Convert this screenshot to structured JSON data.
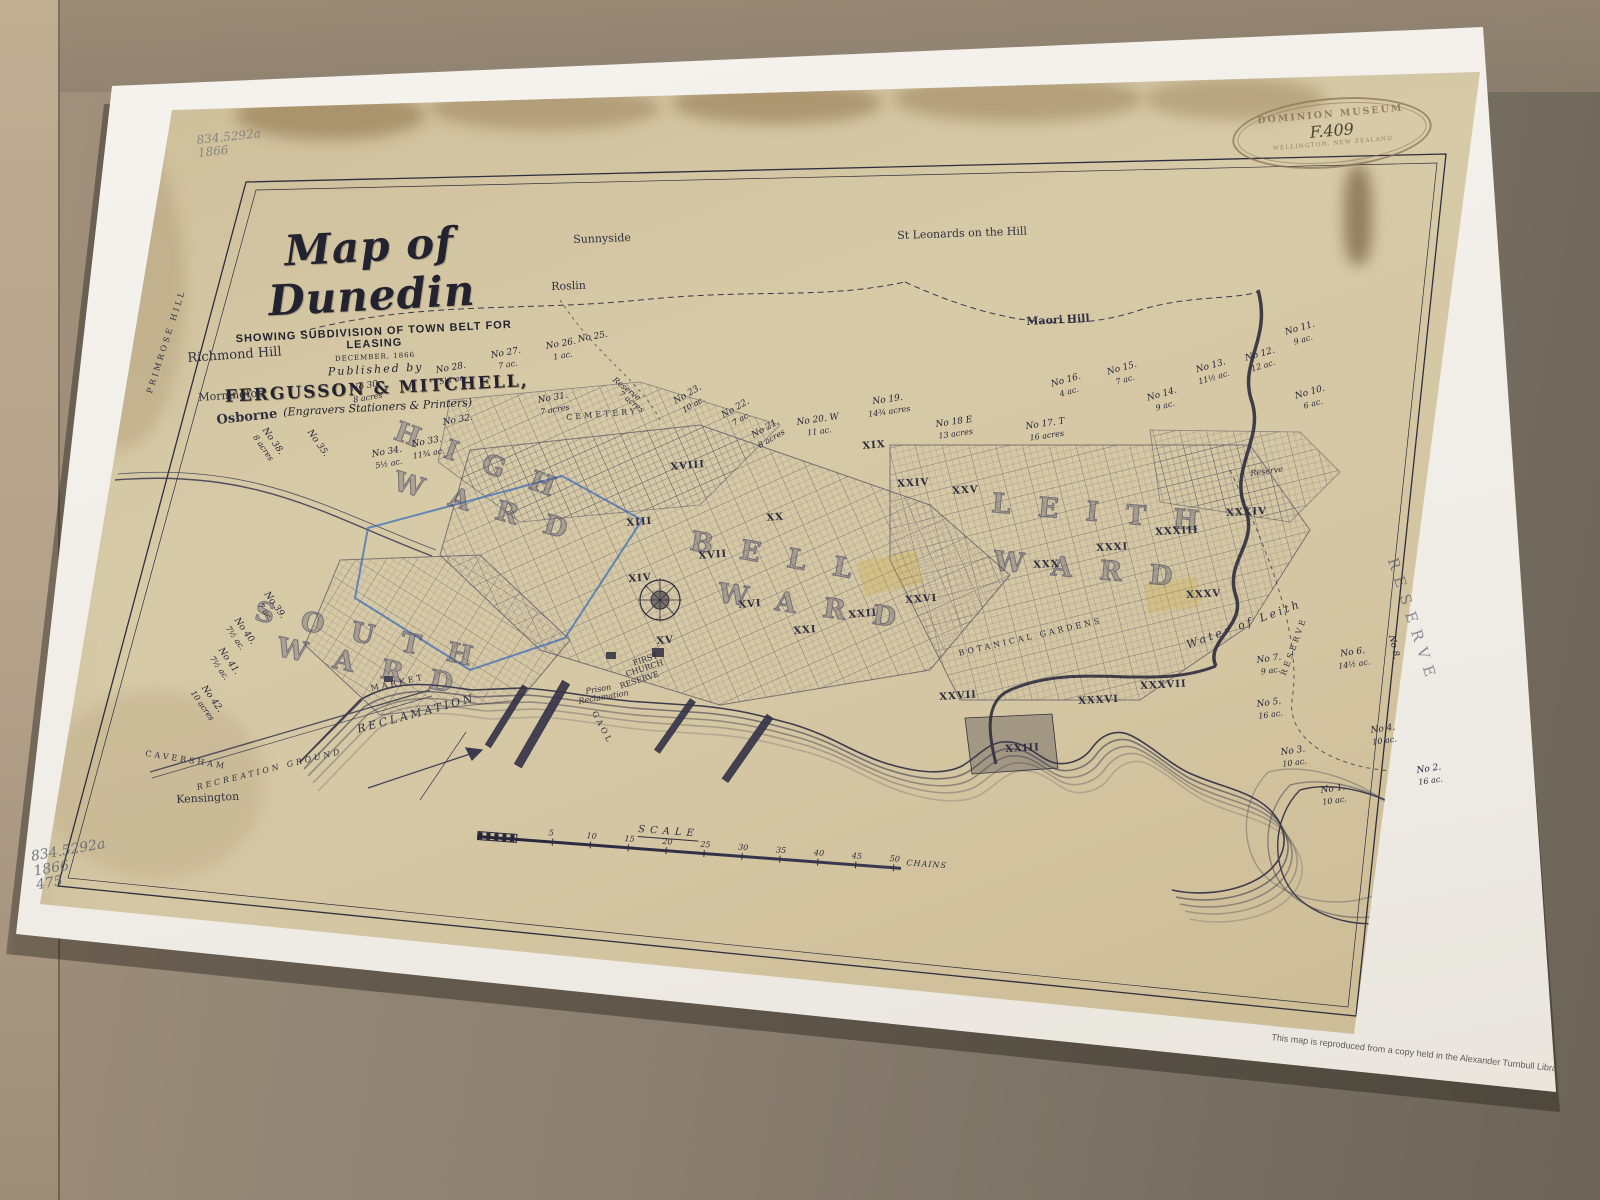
{
  "colors": {
    "table": "#8a7e70",
    "paper": "#f2efe9",
    "map_paper": "#d4c6a2",
    "ink": "#2f2e3e",
    "blue_ink": "#3f6fb5",
    "stamp": "#8a7254",
    "pencil": "#676c72"
  },
  "title_block": {
    "title": "Map of Dunedin",
    "subtitle": "SHOWING SUBDIVISION OF TOWN BELT FOR LEASING",
    "date_line": "DECEMBER, 1866",
    "published_line": "Published by",
    "publisher": "FERGUSSON & MITCHELL,",
    "publisher_sub": "(Engravers Stationers & Printers)"
  },
  "stamp": {
    "arc_top": "DOMINION MUSEUM",
    "number": "F.409",
    "arc_bottom": "WELLINGTON, NEW ZEALAND"
  },
  "annotations": {
    "pencil_top": [
      "834.5292a",
      "1866"
    ],
    "pencil_bottom": [
      "834.5292a",
      "1866",
      "475"
    ]
  },
  "footer": {
    "print_credit": "ed by the Department of Survey and Land Information, Wellington, New Zealand, October 1988.",
    "library_note": "This map is reproduced from a copy held in the Alexander Turnbull Library"
  },
  "scale": {
    "label": "SCALE",
    "unit": "CHAINS",
    "ticks": [
      {
        "t": "5",
        "x": 75
      },
      {
        "t": "10",
        "x": 113
      },
      {
        "t": "15",
        "x": 151
      },
      {
        "t": "20",
        "x": 189
      },
      {
        "t": "25",
        "x": 227
      },
      {
        "t": "30",
        "x": 265
      },
      {
        "t": "35",
        "x": 303
      },
      {
        "t": "40",
        "x": 341
      },
      {
        "t": "45",
        "x": 379
      },
      {
        "t": "50",
        "x": 417
      }
    ]
  },
  "map": {
    "places": [
      {
        "t": "Sunnyside",
        "x": 573,
        "y": 234,
        "rot": -2,
        "cls": "sm"
      },
      {
        "t": "Roslin",
        "x": 551,
        "y": 281,
        "rot": -2,
        "cls": "sm"
      },
      {
        "t": "St Leonards on the Hill",
        "x": 897,
        "y": 230,
        "rot": -2,
        "cls": "sm"
      },
      {
        "t": "Maori Hill",
        "x": 1026,
        "y": 316,
        "rot": -3,
        "cls": "sm b"
      },
      {
        "t": "Richmond Hill",
        "x": 187,
        "y": 352,
        "rot": -4,
        "cls": ""
      },
      {
        "t": "Mornington",
        "x": 198,
        "y": 392,
        "rot": -4,
        "cls": "sm"
      },
      {
        "t": "Osborne",
        "x": 216,
        "y": 414,
        "rot": -6,
        "cls": "b"
      },
      {
        "t": "Kensington",
        "x": 176,
        "y": 794,
        "rot": -3,
        "cls": "sm"
      },
      {
        "t": "PRIMROSE HILL",
        "x": 146,
        "y": 392,
        "rot": -72,
        "cls": "tiny sp"
      },
      {
        "t": "CEMETERY",
        "x": 566,
        "y": 414,
        "rot": -5,
        "cls": "tiny sp"
      },
      {
        "t": "BOTANICAL GARDENS",
        "x": 958,
        "y": 650,
        "rot": -13,
        "cls": "tiny sp"
      },
      {
        "t": "RECLAMATION",
        "x": 356,
        "y": 724,
        "rot": -15,
        "cls": "sm sp it"
      },
      {
        "t": "RECREATION GROUND",
        "x": 196,
        "y": 784,
        "rot": -14,
        "cls": "tiny sp it"
      },
      {
        "t": "FIRST",
        "x": 632,
        "y": 660,
        "rot": -18,
        "cls": "tiny"
      },
      {
        "t": "CHURCH",
        "x": 625,
        "y": 671,
        "rot": -18,
        "cls": "tiny"
      },
      {
        "t": "RESERVE",
        "x": 619,
        "y": 683,
        "rot": -18,
        "cls": "tiny"
      },
      {
        "t": "Prison",
        "x": 585,
        "y": 688,
        "rot": -10,
        "cls": "tiny it"
      },
      {
        "t": "Reclamation",
        "x": 578,
        "y": 698,
        "rot": -10,
        "cls": "tiny it"
      },
      {
        "t": "MARKET",
        "x": 370,
        "y": 685,
        "rot": -12,
        "cls": "tiny sp"
      },
      {
        "t": "GAOL",
        "x": 597,
        "y": 710,
        "rot": 62,
        "cls": "tiny sp"
      },
      {
        "t": "Water of Leith",
        "x": 1185,
        "y": 640,
        "rot": -20,
        "cls": "sm it sp"
      },
      {
        "t": "RESERVE",
        "x": 1280,
        "y": 674,
        "rot": -70,
        "cls": "tiny sp"
      },
      {
        "t": "RESERVE",
        "x": 1399,
        "y": 556,
        "rot": 72,
        "cls": "big2"
      },
      {
        "t": "Reserve",
        "x": 1250,
        "y": 470,
        "rot": -8,
        "cls": "tiny it"
      },
      {
        "t": "Reserve",
        "x": 616,
        "y": 376,
        "rot": 38,
        "cls": "tiny it"
      },
      {
        "t": "7 acres",
        "x": 622,
        "y": 390,
        "rot": 38,
        "cls": "tiny it"
      },
      {
        "t": "CAVERSHAM",
        "x": 146,
        "y": 750,
        "rot": 9,
        "cls": "tiny sp"
      },
      {
        "t": "H I G H",
        "x": 400,
        "y": 418,
        "rot": 20,
        "cls": "ward"
      },
      {
        "t": "W A R D",
        "x": 398,
        "y": 468,
        "rot": 16,
        "cls": "ward"
      },
      {
        "t": "B E L L",
        "x": 693,
        "y": 528,
        "rot": 10,
        "cls": "ward"
      },
      {
        "t": "W A R D",
        "x": 720,
        "y": 580,
        "rot": 8,
        "cls": "ward"
      },
      {
        "t": "S O U T H",
        "x": 258,
        "y": 598,
        "rot": 12,
        "cls": "ward"
      },
      {
        "t": "W A R D",
        "x": 280,
        "y": 634,
        "rot": 12,
        "cls": "ward"
      },
      {
        "t": "L E I T H",
        "x": 993,
        "y": 490,
        "rot": 5,
        "cls": "ward"
      },
      {
        "t": "W A R D",
        "x": 995,
        "y": 548,
        "rot": 5,
        "cls": "ward"
      }
    ],
    "sections": [
      {
        "t": "XIII",
        "x": 626,
        "y": 518,
        "rot": -5
      },
      {
        "t": "XIV",
        "x": 628,
        "y": 574,
        "rot": -5
      },
      {
        "t": "XV",
        "x": 656,
        "y": 636,
        "rot": -5
      },
      {
        "t": "XVI",
        "x": 738,
        "y": 600,
        "rot": -5
      },
      {
        "t": "XVII",
        "x": 698,
        "y": 551,
        "rot": -5
      },
      {
        "t": "XVIII",
        "x": 670,
        "y": 462,
        "rot": -5
      },
      {
        "t": "XIX",
        "x": 862,
        "y": 441,
        "rot": -5
      },
      {
        "t": "XX",
        "x": 766,
        "y": 513,
        "rot": -5
      },
      {
        "t": "XXI",
        "x": 793,
        "y": 626,
        "rot": -5
      },
      {
        "t": "XXII",
        "x": 848,
        "y": 610,
        "rot": -5
      },
      {
        "t": "XXIII",
        "x": 1005,
        "y": 744,
        "rot": -3
      },
      {
        "t": "XXIV",
        "x": 897,
        "y": 479,
        "rot": -4
      },
      {
        "t": "XXV",
        "x": 952,
        "y": 486,
        "rot": -4
      },
      {
        "t": "XXVI",
        "x": 905,
        "y": 595,
        "rot": -4
      },
      {
        "t": "XXVII",
        "x": 939,
        "y": 692,
        "rot": -4
      },
      {
        "t": "XXX",
        "x": 1033,
        "y": 560,
        "rot": -3
      },
      {
        "t": "XXXI",
        "x": 1096,
        "y": 543,
        "rot": -3
      },
      {
        "t": "XXXIII",
        "x": 1155,
        "y": 527,
        "rot": -3
      },
      {
        "t": "XXXIV",
        "x": 1226,
        "y": 508,
        "rot": -3
      },
      {
        "t": "XXXV",
        "x": 1186,
        "y": 590,
        "rot": -3
      },
      {
        "t": "XXXVI",
        "x": 1078,
        "y": 696,
        "rot": -3
      },
      {
        "t": "XXXVII",
        "x": 1140,
        "y": 681,
        "rot": -3
      }
    ],
    "lots": [
      {
        "n": "No 30.",
        "a": "8 acres",
        "x": 350,
        "y": 384,
        "rot": -10
      },
      {
        "n": "No 28.",
        "a": "5¼ ac.",
        "x": 435,
        "y": 366,
        "rot": -10
      },
      {
        "n": "No 27.",
        "a": "7 ac.",
        "x": 490,
        "y": 351,
        "rot": -10
      },
      {
        "n": "No 26.",
        "a": "1 ac.",
        "x": 545,
        "y": 342,
        "rot": -10
      },
      {
        "n": "No 25.",
        "a": "",
        "x": 577,
        "y": 335,
        "rot": -10
      },
      {
        "n": "No 38.",
        "a": "8 acres",
        "x": 268,
        "y": 426,
        "rot": 55
      },
      {
        "n": "No 35.",
        "a": "",
        "x": 313,
        "y": 428,
        "rot": 55
      },
      {
        "n": "No 34.",
        "a": "5½ ac.",
        "x": 371,
        "y": 450,
        "rot": -10
      },
      {
        "n": "No 33.",
        "a": "11¾ ac.",
        "x": 410,
        "y": 440,
        "rot": -10
      },
      {
        "n": "No 32.",
        "a": "",
        "x": 442,
        "y": 418,
        "rot": -10
      },
      {
        "n": "No 31.",
        "a": "7 acres",
        "x": 537,
        "y": 396,
        "rot": -10
      },
      {
        "n": "No 23.",
        "a": "10 ac.",
        "x": 672,
        "y": 398,
        "rot": -30
      },
      {
        "n": "No 22.",
        "a": "7 ac.",
        "x": 720,
        "y": 412,
        "rot": -30
      },
      {
        "n": "No 21.",
        "a": "8 acres",
        "x": 750,
        "y": 432,
        "rot": -30
      },
      {
        "n": "No 20. W",
        "a": "11 ac.",
        "x": 796,
        "y": 418,
        "rot": -8
      },
      {
        "n": "No 19.",
        "a": "14¾ acres",
        "x": 866,
        "y": 398,
        "rot": -8
      },
      {
        "n": "No 18 E",
        "a": "13 acres",
        "x": 935,
        "y": 420,
        "rot": -8
      },
      {
        "n": "No 17. T",
        "a": "16 acres",
        "x": 1025,
        "y": 422,
        "rot": -8
      },
      {
        "n": "No 16.",
        "a": "4 ac.",
        "x": 1050,
        "y": 380,
        "rot": -16
      },
      {
        "n": "No 15.",
        "a": "7 ac.",
        "x": 1106,
        "y": 368,
        "rot": -16
      },
      {
        "n": "No 14.",
        "a": "9 ac.",
        "x": 1146,
        "y": 394,
        "rot": -16
      },
      {
        "n": "No 13.",
        "a": "11½ ac.",
        "x": 1194,
        "y": 366,
        "rot": -16
      },
      {
        "n": "No 12.",
        "a": "12 ac.",
        "x": 1244,
        "y": 354,
        "rot": -16
      },
      {
        "n": "No 11.",
        "a": "9 ac.",
        "x": 1284,
        "y": 328,
        "rot": -16
      },
      {
        "n": "No 10.",
        "a": "6 ac.",
        "x": 1294,
        "y": 392,
        "rot": -16
      },
      {
        "n": "No 8.",
        "a": "",
        "x": 1396,
        "y": 634,
        "rot": 78
      },
      {
        "n": "No 7.",
        "a": "9 ac.",
        "x": 1256,
        "y": 656,
        "rot": -8
      },
      {
        "n": "No 6.",
        "a": "14½ ac.",
        "x": 1336,
        "y": 650,
        "rot": -8
      },
      {
        "n": "No 5.",
        "a": "16 ac.",
        "x": 1256,
        "y": 700,
        "rot": -8
      },
      {
        "n": "No 4.",
        "a": "10 ac.",
        "x": 1370,
        "y": 726,
        "rot": -8
      },
      {
        "n": "No 3.",
        "a": "10 ac.",
        "x": 1280,
        "y": 748,
        "rot": -8
      },
      {
        "n": "No 2.",
        "a": "16 ac.",
        "x": 1416,
        "y": 766,
        "rot": -8
      },
      {
        "n": "No 1.",
        "a": "10 ac.",
        "x": 1320,
        "y": 786,
        "rot": -8
      },
      {
        "n": "No 39.",
        "a": "7 ac.",
        "x": 270,
        "y": 590,
        "rot": 55
      },
      {
        "n": "No 40.",
        "a": "7½ ac.",
        "x": 240,
        "y": 616,
        "rot": 55
      },
      {
        "n": "No 41.",
        "a": "7½ ac.",
        "x": 224,
        "y": 646,
        "rot": 55
      },
      {
        "n": "No 42.",
        "a": "10 acres",
        "x": 206,
        "y": 682,
        "rot": 55
      }
    ]
  }
}
